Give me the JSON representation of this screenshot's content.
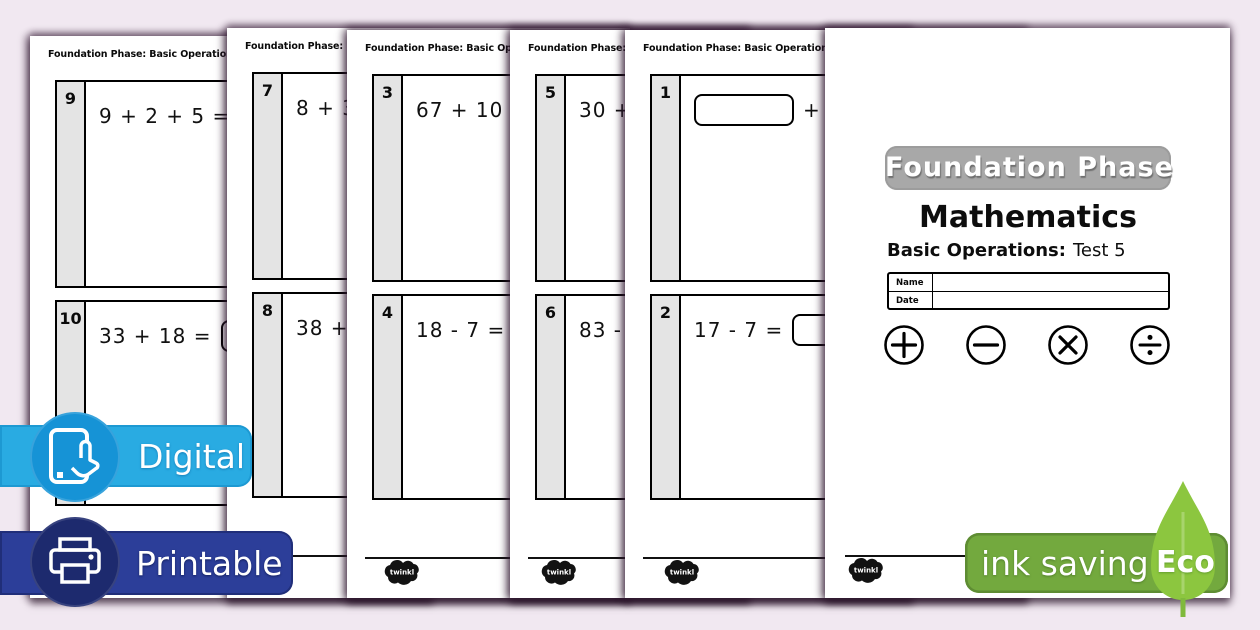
{
  "worksheet": {
    "header": "Foundation Phase: Basic Operations Test 5",
    "logo_text": "twinkl"
  },
  "sheets": [
    {
      "questions": [
        {
          "num": "9",
          "before": "9 + 2 + 5 ="
        },
        {
          "num": "10",
          "before": "33 + 18 ="
        }
      ]
    },
    {
      "questions": [
        {
          "num": "7",
          "before": "8 + 3 ="
        },
        {
          "num": "8",
          "before": "38 +"
        }
      ]
    },
    {
      "questions": [
        {
          "num": "3",
          "before": "67 + 10 ="
        },
        {
          "num": "4",
          "before": "18 - 7 ="
        }
      ]
    },
    {
      "questions": [
        {
          "num": "5",
          "before": "30 + 5"
        },
        {
          "num": "6",
          "before": "83 - 6 ="
        }
      ]
    },
    {
      "questions": [
        {
          "num": "1",
          "after": "+ 7"
        },
        {
          "num": "2",
          "before": "17 - 7 ="
        }
      ]
    }
  ],
  "cover": {
    "phase_badge": "Foundation Phase",
    "subject": "Mathematics",
    "subtitle_bold": "Basic Operations:",
    "subtitle_normal": "Test 5",
    "name_label": "Name",
    "date_label": "Date",
    "operations": [
      "plus",
      "minus",
      "multiply",
      "divide"
    ]
  },
  "badges": {
    "digital": {
      "label": "Digital",
      "bg": "#29abe2",
      "circle": "#1693d6"
    },
    "printable": {
      "label": "Printable",
      "bg": "#2c3e99",
      "circle": "#1d2a6e"
    },
    "eco": {
      "label": "ink saving",
      "eco_label": "Eco",
      "bg": "#73a93e",
      "leaf": "#8cc63f"
    }
  },
  "colors": {
    "background": "#f1e8f1",
    "page": "#ffffff",
    "number_column": "#e4e4e4",
    "phase_badge_gray": "#a8a8a8"
  }
}
